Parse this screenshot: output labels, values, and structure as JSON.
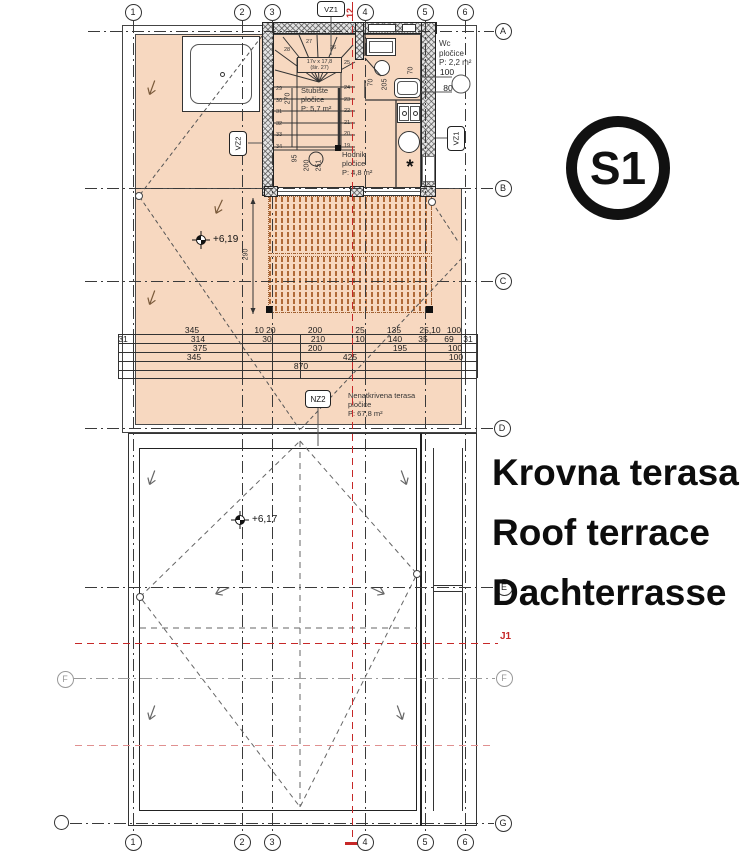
{
  "title_block": {
    "line1": "Krovna terasa",
    "line2": "Roof terrace",
    "line3": "Dachterrasse",
    "badge": "S1"
  },
  "grid": {
    "cols": [
      "1",
      "2",
      "3",
      "4",
      "5",
      "6"
    ],
    "rows": [
      "A",
      "B",
      "C",
      "D",
      "E",
      "F",
      "G"
    ],
    "left_f": "F"
  },
  "tags": {
    "vz1_top": "VZ1",
    "vz1_right": "VZ1",
    "vz2": "VZ2",
    "nz2": "NZ2"
  },
  "red_marks": {
    "section_number": "12",
    "j1": "J1"
  },
  "rooms": {
    "wc": {
      "l1": "Wc",
      "l2": "pločice",
      "l3": "P: 2,2 m²",
      "d1": "100",
      "d2": "80"
    },
    "stubiste": {
      "l1": "Stubište",
      "l2": "pločice",
      "l3": "P: 5,7 m²",
      "spec1": "17v x 17,8",
      "spec2": "(šir. 27)"
    },
    "hodnik": {
      "l1": "Hodnik",
      "l2": "pločice",
      "l3": "P: 4,8 m²"
    },
    "terasa": {
      "l1": "Nenatkrivena terasa",
      "l2": "pločice",
      "l3": "P: 67,8 m²"
    }
  },
  "elevations": {
    "upper": "+6,19",
    "lower": "+6,17"
  },
  "dims": {
    "row1": [
      "345",
      "10 20",
      "200",
      "25",
      "135",
      "25,10",
      "100"
    ],
    "row2": [
      "31",
      "314",
      "30",
      "210",
      "10",
      "140",
      "35",
      "69",
      "31"
    ],
    "row3": [
      "375",
      "200",
      "195",
      "100"
    ],
    "row4": [
      "345",
      "425",
      "100"
    ],
    "row5": [
      "870"
    ],
    "v290": "290",
    "v270": "270",
    "v95": "95",
    "v200": "200",
    "v251": "251",
    "b70a": "70",
    "b205": "205",
    "b70b": "70"
  },
  "stairs": {
    "left_nums": [
      "29",
      "30",
      "31",
      "32",
      "33",
      "34"
    ],
    "right_nums": [
      "24",
      "23",
      "22",
      "21",
      "20",
      "19"
    ],
    "winders": [
      "25",
      "26",
      "27",
      "28"
    ]
  },
  "symbols": {
    "washer": "*"
  },
  "colors": {
    "peach": "#f7d8c0",
    "pergola_stripe": "#b06a38",
    "section_red": "#c62828",
    "line": "#3a3a3a",
    "wall_fill": "#e3e3e3"
  }
}
